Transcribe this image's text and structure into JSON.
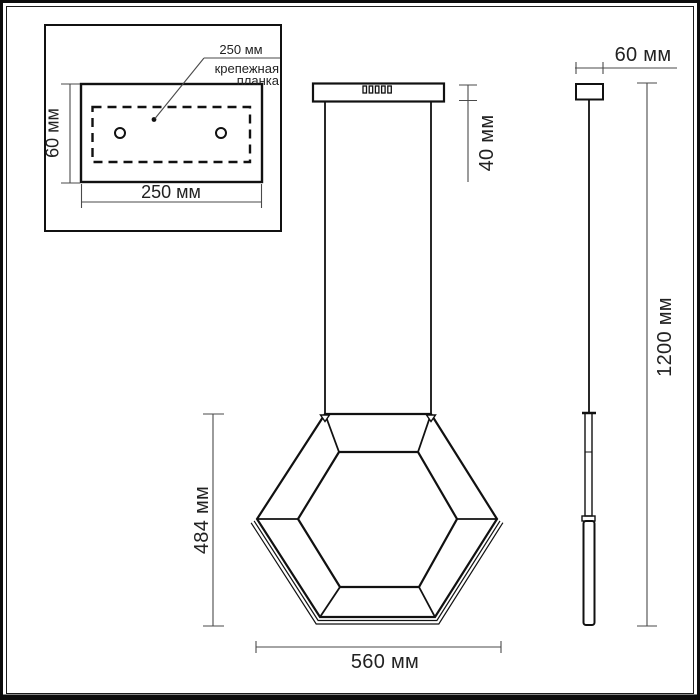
{
  "drawing": {
    "kind": "pendant-light-dimension-drawing",
    "labels": {
      "inset_plate_width_leader": "250 мм",
      "inset_caption_line1": "крепежная",
      "inset_caption_line2": "планка",
      "inset_height": "60 мм",
      "inset_width": "250 мм",
      "canopy_height": "40 мм",
      "shade_height": "484 мм",
      "shade_width": "560 мм",
      "side_canopy_width": "60 мм",
      "suspension_total_height": "1200 мм"
    },
    "colors": {
      "object_line": "#111111",
      "dimension_line": "#4a4a4a",
      "text": "#222222",
      "background": "#ffffff"
    }
  }
}
